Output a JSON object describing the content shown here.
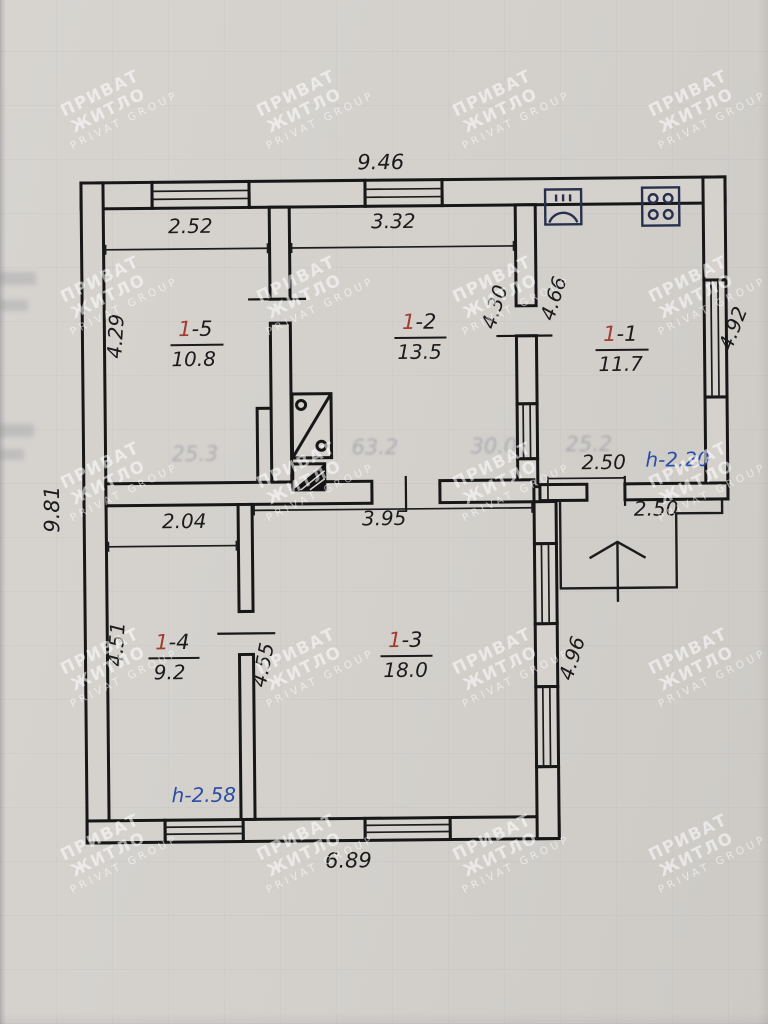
{
  "watermark": {
    "line1": "ПРИВАТ ЖИТЛО",
    "line2": "PRIVAT GROUP"
  },
  "plan": {
    "overall_dims": {
      "top": "9.46",
      "left": "9.81",
      "bottom": "6.89"
    },
    "rooms": {
      "r11": {
        "num_red": "1",
        "num_rest": "-1",
        "area": "11.7"
      },
      "r12": {
        "num_red": "1",
        "num_rest": "-2",
        "area": "13.5"
      },
      "r13": {
        "num_red": "1",
        "num_rest": "-3",
        "area": "18.0"
      },
      "r14": {
        "num_red": "1",
        "num_rest": "-4",
        "area": "9.2"
      },
      "r15": {
        "num_red": "1",
        "num_rest": "-5",
        "area": "10.8"
      }
    },
    "dims": {
      "d946": "9.46",
      "d981": "9.81",
      "d689": "6.89",
      "d252": "2.52",
      "d332": "3.32",
      "d430": "4.30",
      "d466": "4.66",
      "d492": "4.92",
      "d429": "4.29",
      "d204": "2.04",
      "d395": "3.95",
      "d451": "4.51",
      "d455": "4.55",
      "d496": "4.96",
      "d250_kitchen": "2.50",
      "d250_porch": "2.50"
    },
    "heights": {
      "h_kitchen": "h-2.20",
      "h_room": "h-2.58"
    }
  },
  "ghosts": {
    "g1": "63.2",
    "g2": "30.0",
    "g3": "25.2",
    "g4": "25.3"
  },
  "colors": {
    "paper": "#d3d0cc",
    "ink": "#171717",
    "room_number_red": "#a13c2f",
    "height_blue": "#2a4da6",
    "fixture_navy": "#27314e",
    "watermark": "#ffffff"
  }
}
